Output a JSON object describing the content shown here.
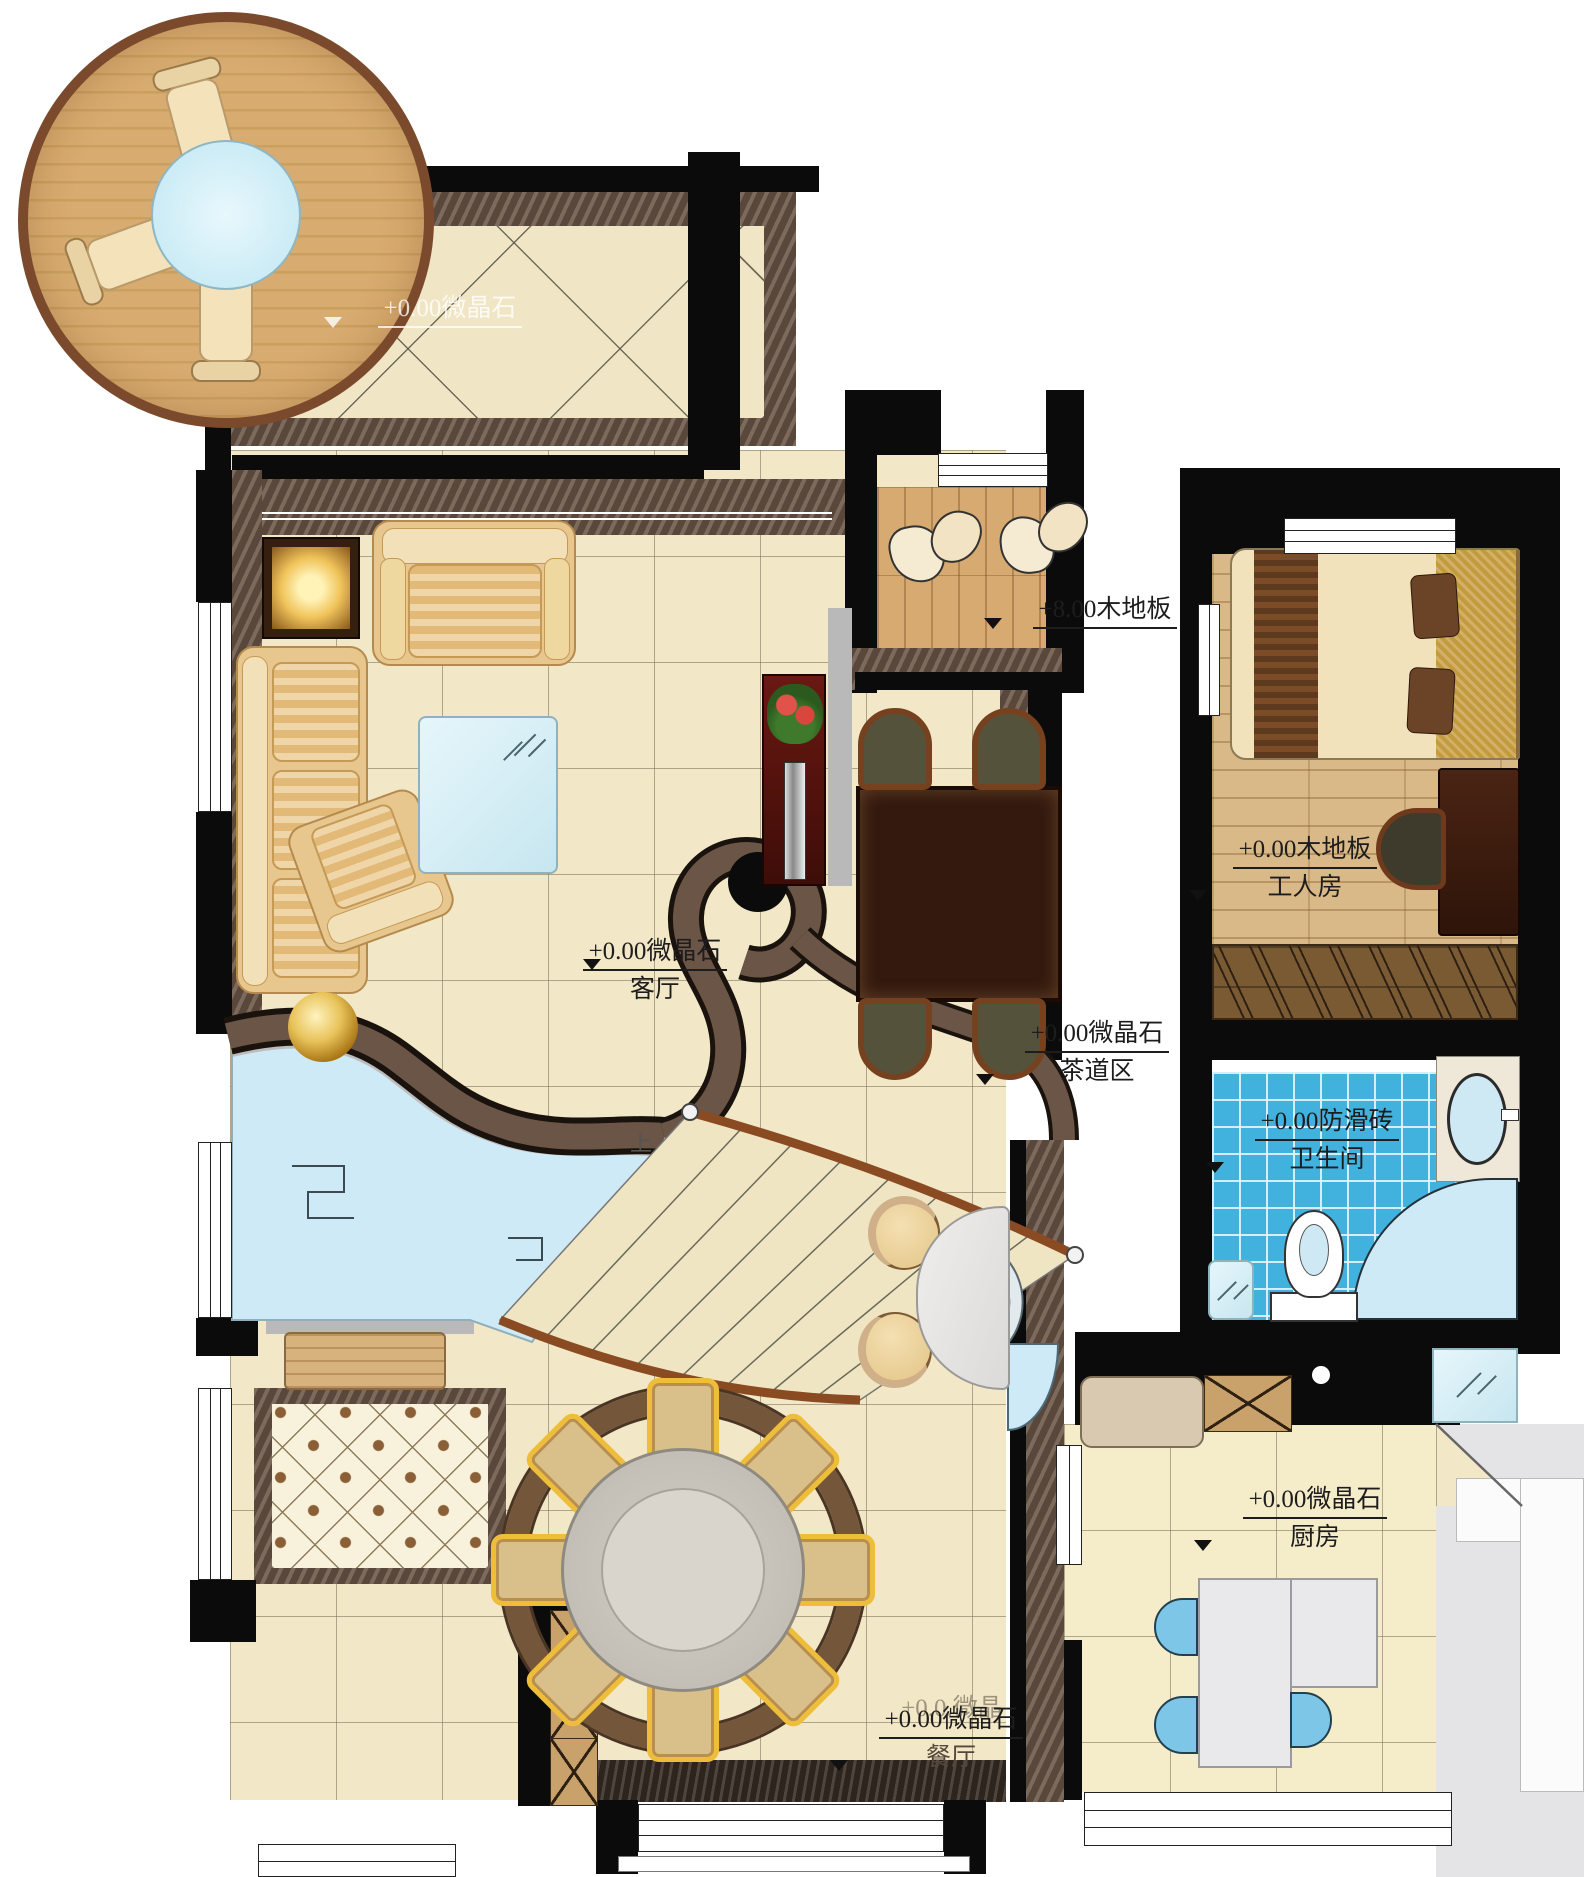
{
  "plan_type": "residential-floor-plan",
  "labels": {
    "terrace": {
      "level": "+0.00微晶石"
    },
    "entry": {
      "level": "+8.00木地板"
    },
    "living": {
      "level": "+0.00微晶石",
      "room": "客厅"
    },
    "tea": {
      "level": "+0.00微晶石",
      "room": "茶道区"
    },
    "worker": {
      "level": "+0.00木地板",
      "room": "工人房"
    },
    "bath": {
      "level": "+0.00防滑砖",
      "room": "卫生间"
    },
    "kitchen": {
      "level": "+0.00微晶石",
      "room": "厨房"
    },
    "dining": {
      "level": "+0.00微晶石",
      "room": "餐厅"
    },
    "dining_ghost": "+0.0.微晶",
    "stair_up": "上"
  },
  "rooms": [
    "客厅",
    "茶道区",
    "工人房",
    "卫生间",
    "厨房",
    "餐厅"
  ],
  "colors": {
    "wall": "#0b0b0b",
    "marble_band": "#6a5546",
    "tile_floor": "#f2e7c6",
    "wood_deck": "#d3a368",
    "deck_rim": "#7b4a2c",
    "water_glass": "#cfeaf7",
    "blue_mosaic": "#41b1de",
    "gold_accent": "#d8a93c",
    "sofa_fabric": "#e7c78e",
    "dark_wood": "#33190e",
    "kitchen_gray": "#e4e4e6"
  }
}
